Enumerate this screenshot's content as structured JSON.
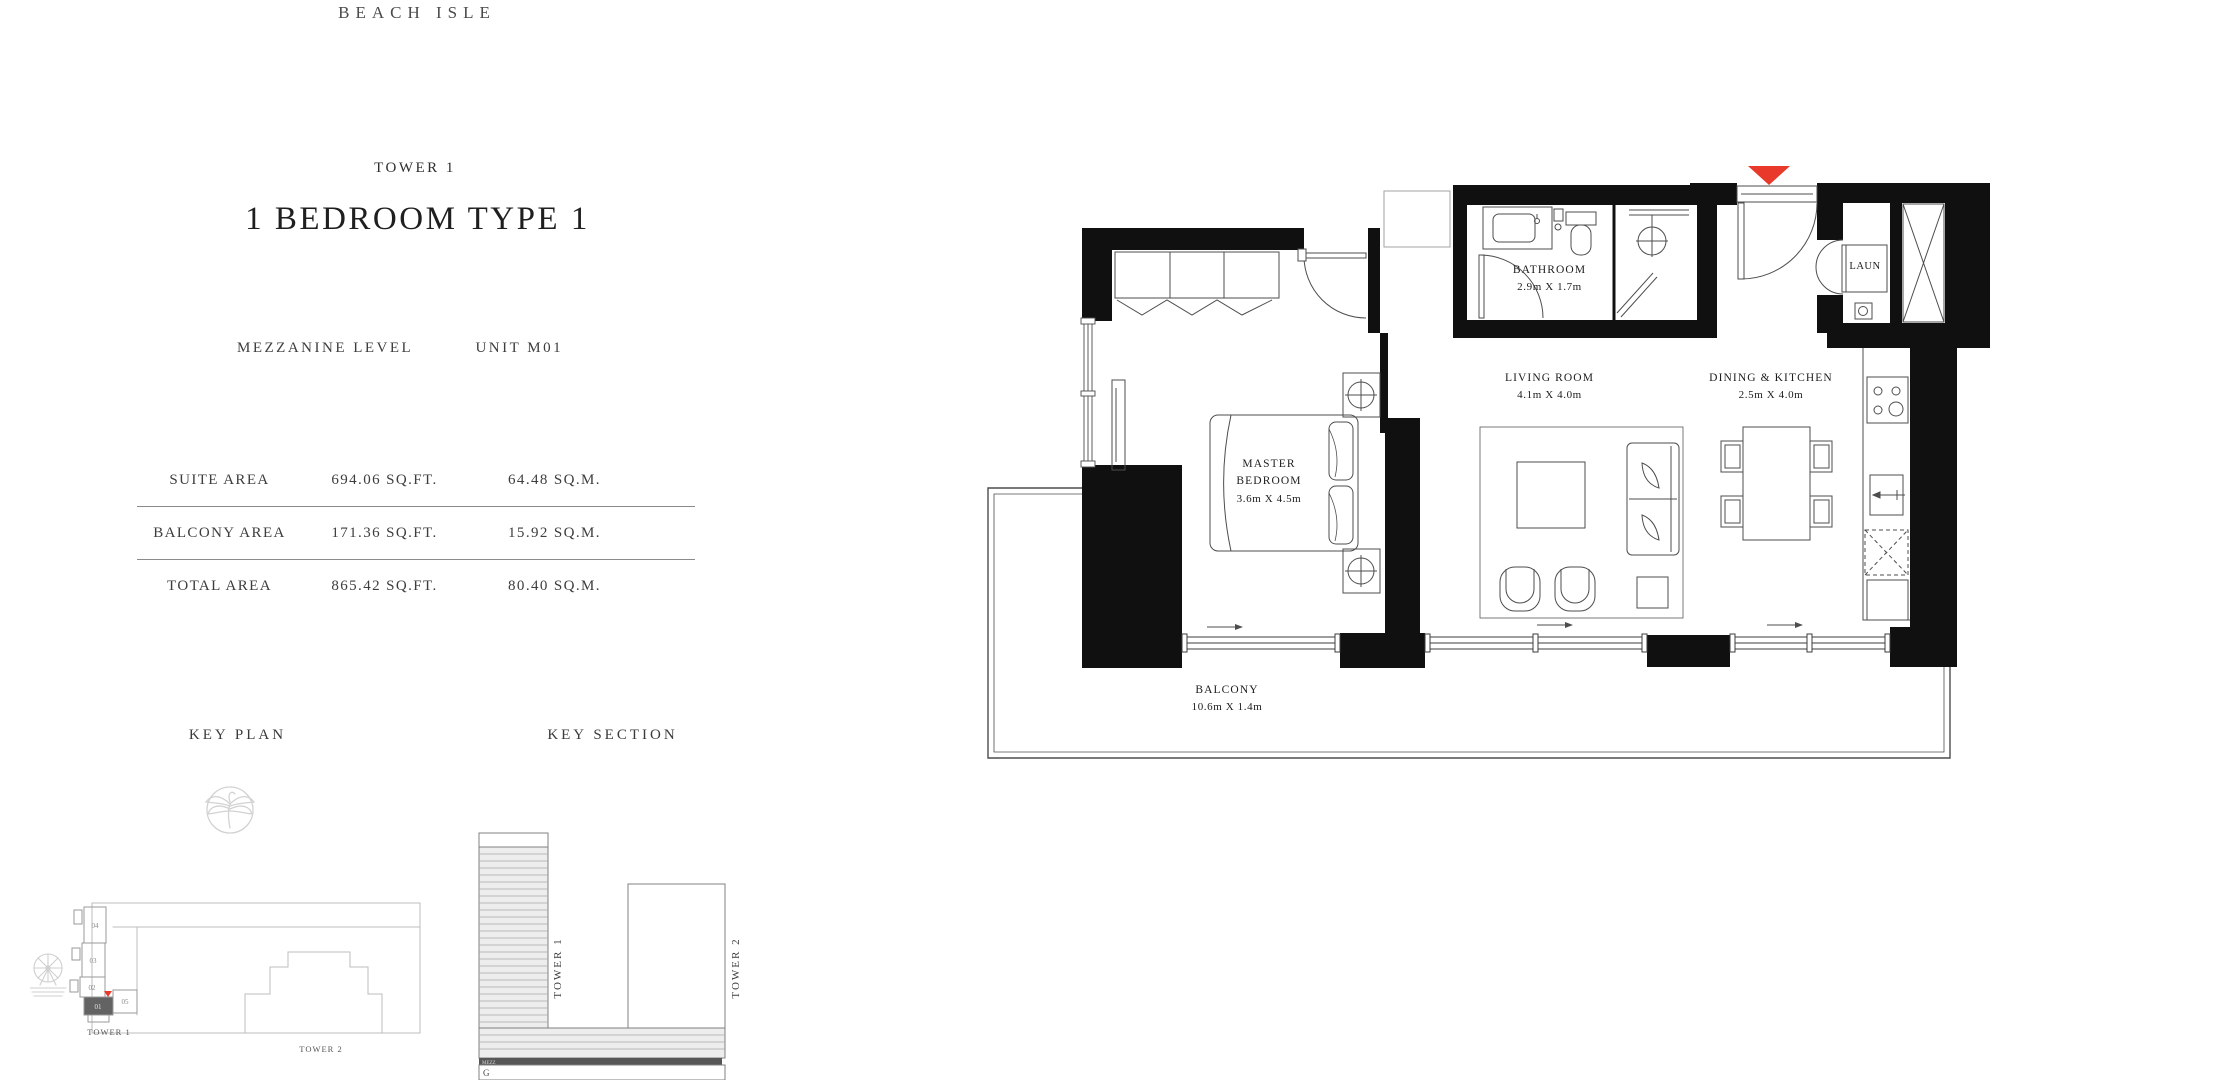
{
  "brand": "BEACH ISLE",
  "header": {
    "tower": "TOWER 1",
    "title": "1 BEDROOM TYPE 1",
    "level": "MEZZANINE LEVEL",
    "unit": "UNIT M01"
  },
  "area_table": {
    "rows": [
      {
        "label": "SUITE AREA",
        "sqft": "694.06 SQ.FT.",
        "sqm": "64.48 SQ.M."
      },
      {
        "label": "BALCONY AREA",
        "sqft": "171.36 SQ.FT.",
        "sqm": "15.92 SQ.M."
      },
      {
        "label": "TOTAL AREA",
        "sqft": "865.42 SQ.FT.",
        "sqm": "80.40 SQ.M."
      }
    ]
  },
  "key_plan": {
    "heading": "KEY PLAN",
    "tower1": "TOWER 1",
    "tower2": "TOWER 2",
    "units": [
      "04",
      "03",
      "02",
      "01",
      "05"
    ],
    "highlighted_unit": "01"
  },
  "key_section": {
    "heading": "KEY SECTION",
    "tower1": "TOWER 1",
    "tower2": "TOWER 2",
    "mezz": "MEZZ",
    "ground": "G"
  },
  "floor_plan": {
    "master_bedroom": {
      "name": "MASTER BEDROOM",
      "dims": "3.6m X 4.5m"
    },
    "bathroom": {
      "name": "BATHROOM",
      "dims": "2.9m X 1.7m"
    },
    "living_room": {
      "name": "LIVING ROOM",
      "dims": "4.1m X 4.0m"
    },
    "dining_kitchen": {
      "name": "DINING & KITCHEN",
      "dims": "2.5m X 4.0m"
    },
    "balcony": {
      "name": "BALCONY",
      "dims": "10.6m X 1.4m"
    },
    "laundry": {
      "name": "LAUN"
    }
  },
  "colors": {
    "entry_marker_red": "#E8392B",
    "wall_black": "#101010",
    "highlight_gray": "#636363",
    "mezz_dark": "#565656"
  }
}
